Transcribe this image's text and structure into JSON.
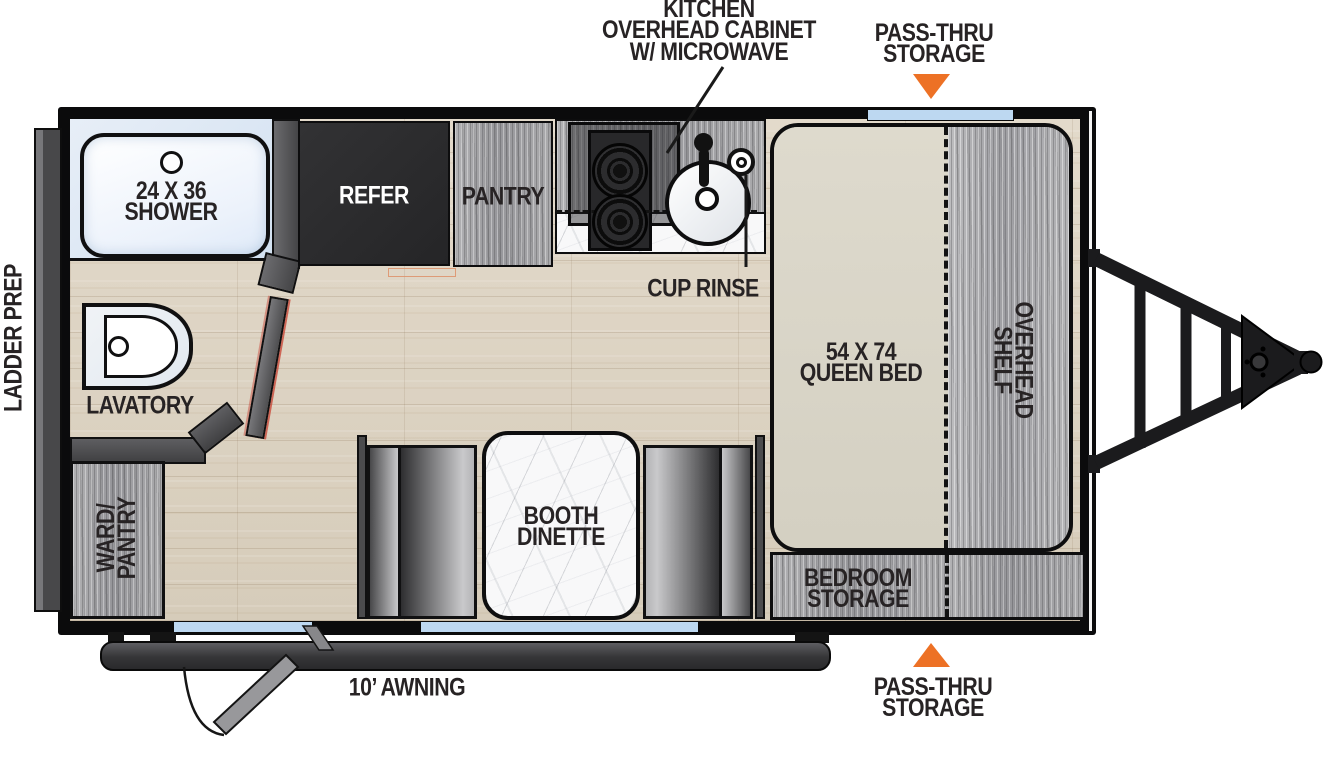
{
  "diagram": {
    "type": "travel-trailer-floorplan",
    "callouts": {
      "kitchen_overhead_cabinet": [
        "KITCHEN",
        "OVERHEAD CABINET",
        "W/ MICROWAVE"
      ],
      "pass_thru_storage_top": [
        "PASS-THRU",
        "STORAGE"
      ],
      "pass_thru_storage_bottom": [
        "PASS-THRU",
        "STORAGE"
      ],
      "ladder_prep": "LADDER PREP",
      "awning": "10’ AWNING",
      "cup_rinse": "CUP RINSE"
    },
    "rooms": {
      "shower": [
        "24 X 36",
        "SHOWER"
      ],
      "refrigerator": "REFER",
      "pantry": "PANTRY",
      "lavatory": "LAVATORY",
      "wardrobe_pantry": [
        "WARD/",
        "PANTRY"
      ],
      "booth_dinette": [
        "BOOTH",
        "DINETTE"
      ],
      "queen_bed": [
        "54 X 74",
        "QUEEN BED"
      ],
      "overhead_shelf": [
        "OVERHEAD",
        "SHELF"
      ],
      "bedroom_storage": [
        "BEDROOM",
        "STORAGE"
      ]
    },
    "colors": {
      "accent_orange": "#ED7125",
      "window_blue": "#BDD8F1",
      "wall_black": "#0B0B0C",
      "partition_gray": "#4D4D4F",
      "cabinet_dark": "#2B2B2D",
      "wood_floor": "#DCD2C2",
      "gray_wood": "#A3A3A5",
      "bed_beige": "#DAD6C9"
    }
  }
}
